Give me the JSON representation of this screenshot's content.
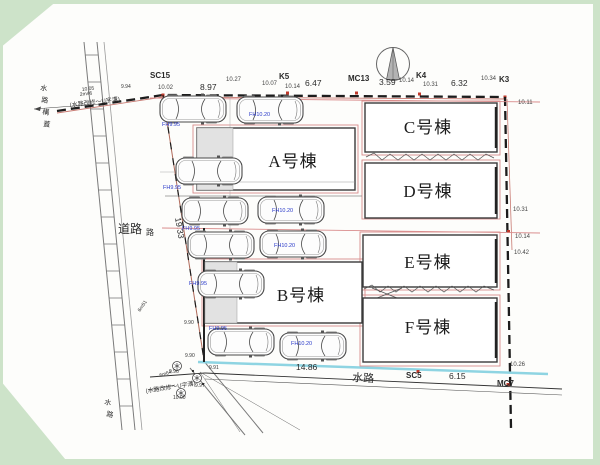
{
  "survey": {
    "top": [
      "SC15",
      "10.02",
      "8.97",
      "10.27",
      "10.07",
      "K5",
      "10.14",
      "6.47",
      "MC13",
      "3.59",
      "10.14",
      "K4",
      "10.31",
      "6.32",
      "10.34",
      "K3"
    ],
    "right": [
      "10.11",
      "10.31",
      "10.14",
      "10.42",
      "10.26"
    ],
    "bottom": [
      "14.86",
      "水路",
      "SC5",
      "6.15",
      "MC7"
    ],
    "left": [
      "19.33"
    ]
  },
  "buildings": {
    "a": "A号棟",
    "b": "B号棟",
    "c": "C号棟",
    "d": "D号棟",
    "e": "E号棟",
    "f": "F号棟"
  },
  "road": {
    "main": "道路",
    "small": "路"
  },
  "waterway": {
    "left_chars": [
      "水",
      "路",
      "構",
      "蓋"
    ],
    "bottom_left_chars": [
      "水",
      "路"
    ]
  },
  "levels": {
    "fh": [
      "FH9.95",
      "FH10.20",
      "FH9.95",
      "FH10.20",
      "FH9.95",
      "FH10.20",
      "FH9.95",
      "FH9.95",
      "FH10.20"
    ],
    "spots": [
      "9.94",
      "9.90",
      "9.90",
      "9.91",
      "9.96",
      "9.97",
      "10.00"
    ]
  },
  "notes": {
    "upper": {
      "text": "(水路改修〜U字溝)",
      "dim1": "10.05",
      "dim2": "2m46"
    },
    "lower": {
      "text": "(水路改修〜U字溝)",
      "dim": "6m64"
    },
    "mid_dim": "6m51"
  },
  "colors": {
    "boundary_red": "#c87a72",
    "fh_blue": "#2838c8",
    "waterway_cyan": "#8ed4e2",
    "scan_green": "#cde3c9"
  }
}
